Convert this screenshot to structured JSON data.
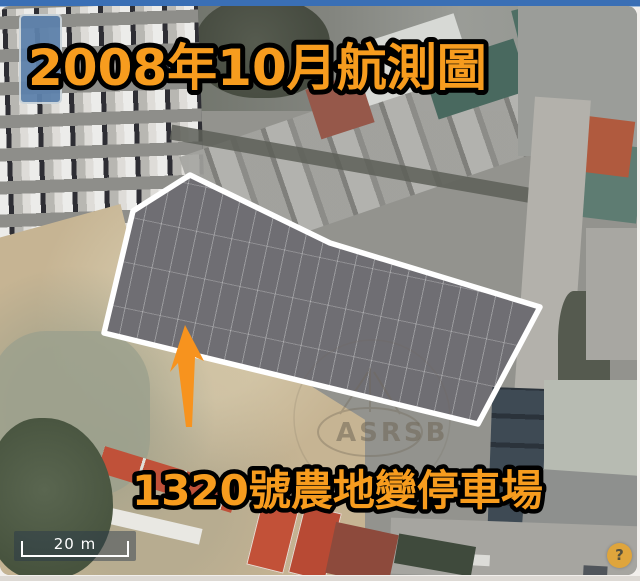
{
  "title": {
    "text": "2008年10月航測圖",
    "color": "#F79C1E",
    "outline_color": "#000000"
  },
  "annotation": {
    "caption": "1320號農地變停車場",
    "caption_color": "#F79C1E",
    "boundary_color": "#FFFFFF",
    "arrow_color": "#F7931E"
  },
  "map_controls": {
    "scale_bar": {
      "label": "20 m"
    },
    "help_button": {
      "label": "?",
      "color": "#DFA53C"
    }
  },
  "watermark": {
    "text": "ASRSB"
  },
  "frame": {
    "top_bar_color": "#3A6FB5"
  }
}
